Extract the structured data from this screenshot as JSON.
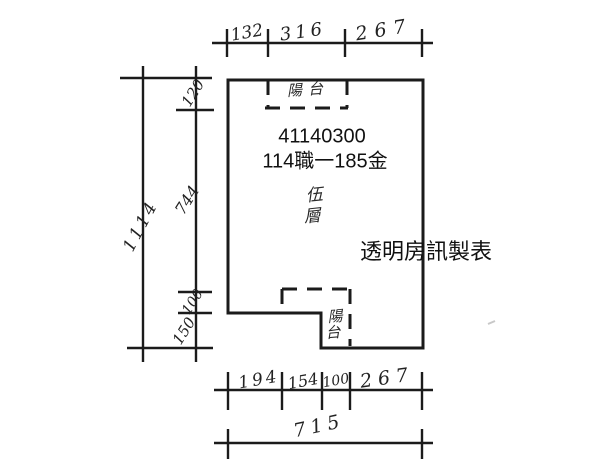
{
  "drawing": {
    "type": "floor-plan-sketch",
    "unit_number": "41140300",
    "lot_label": "114職一185金",
    "floor_label": "伍層",
    "floor_chars": [
      "伍",
      "層"
    ],
    "balcony_label": "陽台",
    "balcony_chars": [
      "陽",
      "台"
    ],
    "canopy_label": "陽台",
    "watermark": "透明房訊製表"
  },
  "dimensions": {
    "top": {
      "segments": [
        "132",
        "316",
        "267"
      ]
    },
    "left": {
      "total": "1114",
      "segments": [
        "120",
        "744",
        "100",
        "150"
      ]
    },
    "bottom": {
      "segments": [
        "194",
        "154",
        "100",
        "267"
      ],
      "total": "715"
    }
  },
  "colors": {
    "ink": "#1b1b1b",
    "background": "#ffffff",
    "stray_mark": "#c8c8c8"
  }
}
